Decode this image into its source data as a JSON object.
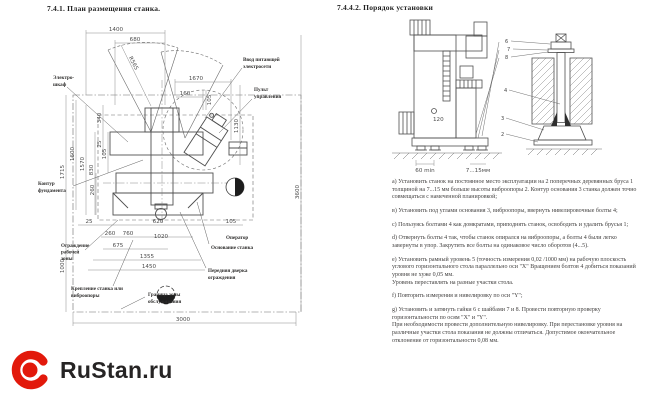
{
  "page": {
    "background": "#ffffff",
    "brand_red": "#e2190b",
    "ink": "#262424"
  },
  "left_section": {
    "title": "7.4.1. План размещения станка.",
    "drawing": {
      "dims": {
        "d1400": "1400",
        "d680": "680",
        "r565": "R565",
        "d1670": "1670",
        "d160": "160",
        "d105top": "105",
        "d1715": "1715",
        "d1600": "1600",
        "d1570": "1570",
        "d830": "830",
        "d340": "340",
        "d25left": "25",
        "d105left": "105",
        "d260left": "260",
        "d1130": "1130",
        "d3600": "3600",
        "d1000": "1000",
        "d25bot": "25",
        "d620": "620",
        "d105bot": "105",
        "d260bot": "260",
        "d760": "760",
        "d1020": "1020",
        "d675": "675",
        "d1355": "1355",
        "d1450": "1450",
        "d3000": "3000"
      },
      "labels": {
        "electro": [
          "Электро-",
          "шкаф"
        ],
        "vvod": [
          "Ввод питающей",
          "электросети"
        ],
        "pult": [
          "Пульт",
          "управления"
        ],
        "kontur": [
          "Контур",
          "фундамента"
        ],
        "ograzhdenie": [
          "Ограждение",
          "рабочей",
          "зоны"
        ],
        "kreplenie": [
          "Крепление станка или",
          "виброопоры"
        ],
        "granitsa": [
          "Граница зоны",
          "обслуживания"
        ],
        "operator": "Оператор",
        "osnovanie": "Основание станка",
        "dverka": [
          "Передняя дверка",
          "ограждения"
        ]
      }
    }
  },
  "right_section": {
    "title": "7.4.4.2. Порядок установки",
    "drawing": {
      "dims": {
        "min60": "60 min",
        "gap": "7...15мм",
        "d120": "120"
      },
      "callouts": {
        "c6": "6",
        "c7": "7",
        "c8": "8",
        "c4": "4",
        "c3": "3",
        "c2": "2"
      }
    },
    "paragraphs": [
      "а) Установить станок на постоянное место эксплуатации на 2 поперечных деревянных бруса 1 толщиной на 7...15 мм больше высоты виброопоры 2. Контур основания 3 станка должен точно совмещаться с намеченной планировкой;",
      "в) Установить под углами основания 3, виброопоры, ввернуть нивелировочные болты 4;",
      "с) Пользуясь болтами 4 как домкратами, приподнять станок, освободить и удалить брусья 1;",
      "d) Отвернуть болты 4 так, чтобы станок опирался на виброопоры, а болты 4 были легко завернуты в упор. Закрутить все болты на одинаковое число оборотов (4...5).",
      "е) Установить рамный уровень 5 (точность измерения 0,02 /1000 мм) на рабочую плоскость углового горизонтального стола параллельно оси \"X\" Вращением болтов 4 добиться показаний уровня не хуже 0,05 мм.\nУровень переставлять на разные участки стола.",
      "f) Повторить измерения и нивелировку по оси \"Y\";",
      "g) Установить и затянуть гайки 6 с шайбами 7 и 8. Провести повторную проверку горизонтальности по осям \"X\" и \"Y\".\nПри необходимости провести дополнительную нивелировку. При перестановке уровня на различные участки стола показания не должны отличаться. Допустимое окончательное отклонение от горизонтальности 0,08 мм."
    ]
  },
  "footer": {
    "logo_text": "RuStan.ru"
  }
}
